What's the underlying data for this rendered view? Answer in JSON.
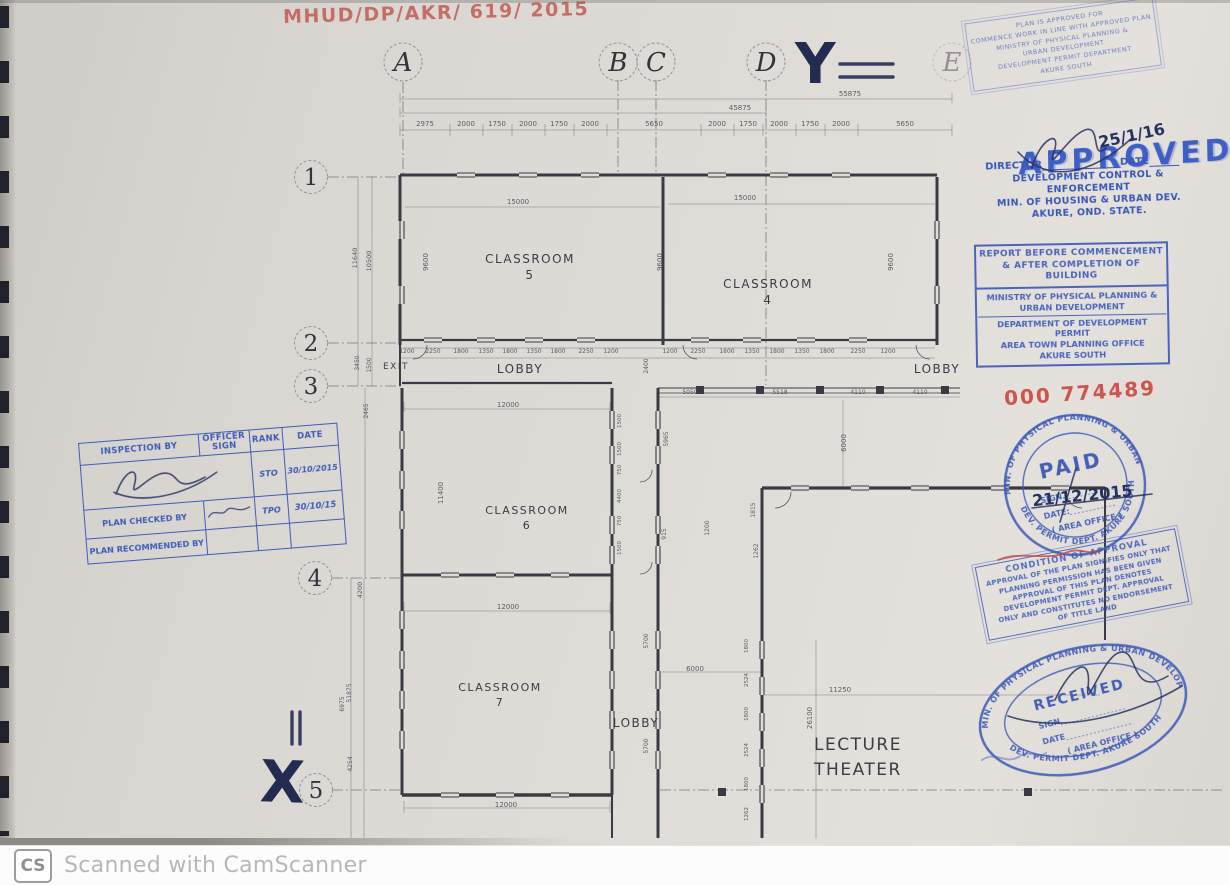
{
  "page": {
    "watermark_icon": "CS",
    "watermark_text": "Scanned with CamScanner"
  },
  "colors": {
    "stamp_blue": "#3a57b8",
    "ink_red": "#c0544c",
    "pen_navy": "#26335e",
    "paper": "#dedad5",
    "line": "#3a3a43"
  },
  "annotations": {
    "file_number": "MHUD/DP/AKR/ 619/ 2015",
    "receipt_number": "000 774489",
    "mark_x": "X",
    "mark_y": "Y",
    "approval_date": "25/1/16",
    "paid_date": "21/12/2015"
  },
  "grid": {
    "columns": [
      {
        "label": "A",
        "x": 403
      },
      {
        "label": "B",
        "x": 618
      },
      {
        "label": "C",
        "x": 656
      },
      {
        "label": "D",
        "x": 766
      },
      {
        "label": "E",
        "x": 952,
        "faint": true
      }
    ],
    "rows": [
      {
        "label": "1",
        "x": 311,
        "y": 177
      },
      {
        "label": "2",
        "x": 311,
        "y": 343
      },
      {
        "label": "3",
        "x": 311,
        "y": 386
      },
      {
        "label": "4",
        "x": 315,
        "y": 578
      },
      {
        "label": "5",
        "x": 316,
        "y": 790
      }
    ]
  },
  "plan": {
    "texts": [
      [
        "CLASSROOM",
        530,
        263,
        12,
        0,
        "room"
      ],
      [
        "5",
        530,
        279,
        12,
        0,
        "room"
      ],
      [
        "CLASSROOM",
        768,
        288,
        12,
        0,
        "room"
      ],
      [
        "4",
        768,
        304,
        12,
        0,
        "room"
      ],
      [
        "CLASSROOM",
        527,
        514,
        11,
        0,
        "room"
      ],
      [
        "6",
        527,
        529,
        11,
        0,
        "room"
      ],
      [
        "CLASSROOM",
        500,
        691,
        11,
        0,
        "room"
      ],
      [
        "7",
        500,
        706,
        11,
        0,
        "room"
      ],
      [
        "LOBBY",
        520,
        373,
        12,
        0,
        "room"
      ],
      [
        "LOBBY",
        937,
        373,
        12,
        0,
        "room"
      ],
      [
        "LOBBY",
        636,
        727,
        12,
        0,
        "room"
      ],
      [
        "EXIT",
        396,
        369,
        9,
        0,
        "room"
      ],
      [
        "LECTURE",
        858,
        750,
        17,
        0,
        "room"
      ],
      [
        "THEATER",
        858,
        775,
        17,
        0,
        "room"
      ],
      [
        "2975",
        425,
        126
      ],
      [
        "2000",
        466,
        126
      ],
      [
        "1750",
        497,
        126
      ],
      [
        "2000",
        528,
        126
      ],
      [
        "1750",
        559,
        126
      ],
      [
        "2000",
        590,
        126
      ],
      [
        "5650",
        654,
        126
      ],
      [
        "2000",
        717,
        126
      ],
      [
        "1750",
        748,
        126
      ],
      [
        "2000",
        779,
        126
      ],
      [
        "1750",
        810,
        126
      ],
      [
        "2000",
        841,
        126
      ],
      [
        "5650",
        905,
        126
      ],
      [
        "45875",
        740,
        110
      ],
      [
        "55875",
        850,
        96
      ],
      [
        "15000",
        518,
        204
      ],
      [
        "15000",
        745,
        200
      ],
      [
        "9600",
        428,
        262,
        7,
        -90
      ],
      [
        "9600",
        662,
        262,
        7,
        -90
      ],
      [
        "9600",
        893,
        262,
        7,
        -90
      ],
      [
        "1200",
        407,
        353,
        6
      ],
      [
        "2250",
        433,
        353,
        6
      ],
      [
        "1800",
        461,
        353,
        6
      ],
      [
        "1350",
        486,
        353,
        6
      ],
      [
        "1800",
        510,
        353,
        6
      ],
      [
        "1350",
        534,
        353,
        6
      ],
      [
        "1800",
        558,
        353,
        6
      ],
      [
        "2250",
        586,
        353,
        6
      ],
      [
        "1200",
        611,
        353,
        6
      ],
      [
        "1200",
        670,
        353,
        6
      ],
      [
        "2250",
        698,
        353,
        6
      ],
      [
        "1800",
        727,
        353,
        6
      ],
      [
        "1350",
        752,
        353,
        6
      ],
      [
        "1800",
        777,
        353,
        6
      ],
      [
        "1350",
        802,
        353,
        6
      ],
      [
        "1800",
        827,
        353,
        6
      ],
      [
        "2250",
        858,
        353,
        6
      ],
      [
        "1200",
        888,
        353,
        6
      ],
      [
        "2400",
        648,
        366,
        6,
        -90
      ],
      [
        "11640",
        357,
        258,
        6.5,
        -90
      ],
      [
        "10500",
        371,
        261,
        6.5,
        -90
      ],
      [
        "3450",
        359,
        363,
        6,
        -90
      ],
      [
        "1500",
        371,
        365,
        6,
        -90
      ],
      [
        "2465",
        368,
        411,
        6,
        -90
      ],
      [
        "4200",
        362,
        590,
        6.5,
        -90
      ],
      [
        "51875",
        351,
        693,
        6,
        -90
      ],
      [
        "6975",
        344,
        704,
        6,
        -90
      ],
      [
        "4254",
        352,
        764,
        6,
        -90
      ],
      [
        "12000",
        508,
        407
      ],
      [
        "11400",
        443,
        493,
        7,
        -90
      ],
      [
        "12000",
        508,
        609
      ],
      [
        "12000",
        506,
        807
      ],
      [
        "5050",
        690,
        394,
        6
      ],
      [
        "5518",
        780,
        394,
        6
      ],
      [
        "4110",
        858,
        394,
        6
      ],
      [
        "4110",
        920,
        394,
        6
      ],
      [
        "5965",
        668,
        439,
        6,
        -90
      ],
      [
        "915",
        666,
        534,
        6,
        -90
      ],
      [
        "1500",
        621,
        421,
        5.5,
        -90
      ],
      [
        "1500",
        621,
        449,
        5.5,
        -90
      ],
      [
        "750",
        621,
        470,
        5.5,
        -90
      ],
      [
        "4400",
        621,
        496,
        5.5,
        -90
      ],
      [
        "750",
        621,
        521,
        5.5,
        -90
      ],
      [
        "1500",
        621,
        548,
        5.5,
        -90
      ],
      [
        "1200",
        709,
        528,
        6,
        -90
      ],
      [
        "1815",
        755,
        510,
        6,
        -90
      ],
      [
        "1262",
        758,
        551,
        6,
        -90
      ],
      [
        "6000",
        846,
        443,
        7,
        -90
      ],
      [
        "5700",
        648,
        641,
        6,
        -90
      ],
      [
        "5700",
        648,
        746,
        6,
        -90
      ],
      [
        "6000",
        695,
        671
      ],
      [
        "11250",
        840,
        692
      ],
      [
        "26100",
        812,
        718,
        7,
        -90
      ],
      [
        "1800",
        748,
        646,
        5.5,
        -90
      ],
      [
        "2524",
        748,
        680,
        5.5,
        -90
      ],
      [
        "1800",
        748,
        714,
        5.5,
        -90
      ],
      [
        "2524",
        748,
        750,
        5.5,
        -90
      ],
      [
        "1800",
        748,
        784,
        5.5,
        -90
      ],
      [
        "1262",
        748,
        814,
        5.5,
        -90
      ]
    ],
    "walls": [
      [
        400,
        175,
        937,
        175,
        3
      ],
      [
        400,
        175,
        400,
        345,
        3
      ],
      [
        663,
        177,
        663,
        345,
        3
      ],
      [
        937,
        177,
        937,
        345,
        3
      ],
      [
        400,
        340,
        937,
        340,
        2.2
      ],
      [
        400,
        345,
        400,
        386,
        2
      ],
      [
        402,
        383,
        612,
        383,
        2.2
      ],
      [
        402,
        388,
        402,
        795,
        3
      ],
      [
        612,
        388,
        612,
        795,
        3
      ],
      [
        658,
        388,
        658,
        838,
        3
      ],
      [
        612,
        795,
        612,
        838,
        2
      ],
      [
        402,
        575,
        612,
        575,
        3
      ],
      [
        402,
        795,
        612,
        795,
        3.5
      ],
      [
        762,
        488,
        762,
        838,
        3
      ],
      [
        762,
        488,
        1105,
        488,
        3.2
      ],
      [
        1105,
        488,
        1105,
        640,
        2
      ],
      [
        658,
        388,
        960,
        388,
        1
      ],
      [
        658,
        393,
        960,
        393,
        0.8
      ]
    ],
    "dlines": [
      [
        400,
        130,
        952,
        130
      ],
      [
        400,
        113,
        766,
        113
      ],
      [
        400,
        99,
        952,
        99
      ],
      [
        405,
        207,
        660,
        207
      ],
      [
        668,
        204,
        935,
        204
      ],
      [
        404,
        409,
        610,
        409
      ],
      [
        404,
        611,
        610,
        611
      ],
      [
        404,
        808,
        610,
        808
      ],
      [
        400,
        348,
        935,
        348
      ],
      [
        400,
        358,
        935,
        358
      ],
      [
        358,
        177,
        358,
        386
      ],
      [
        372,
        177,
        372,
        386
      ],
      [
        351,
        578,
        351,
        838
      ],
      [
        364,
        578,
        364,
        838
      ],
      [
        365,
        388,
        365,
        578
      ],
      [
        658,
        397,
        960,
        397
      ],
      [
        843,
        400,
        843,
        486
      ],
      [
        765,
        695,
        1100,
        695
      ],
      [
        816,
        640,
        816,
        838
      ],
      [
        660,
        672,
        762,
        672
      ]
    ],
    "ticks": [
      {
        "y1": 124,
        "y2": 136,
        "xs": [
          400,
          450,
          483,
          512,
          545,
          574,
          607,
          701,
          734,
          763,
          796,
          825,
          858,
          952
        ]
      },
      {
        "y1": 107,
        "y2": 117,
        "xs": [
          400,
          766
        ]
      },
      {
        "y1": 93,
        "y2": 103,
        "xs": [
          400,
          952
        ]
      },
      {
        "y1": 402,
        "y2": 412,
        "xs": [
          404,
          610
        ]
      },
      {
        "y1": 602,
        "y2": 614,
        "xs": [
          404,
          610
        ]
      },
      {
        "y1": 801,
        "y2": 813,
        "xs": [
          404,
          610
        ]
      }
    ],
    "dash": [
      [
        403,
        82,
        403,
        175
      ],
      [
        618,
        80,
        618,
        175
      ],
      [
        656,
        80,
        656,
        175
      ],
      [
        766,
        80,
        766,
        175
      ],
      [
        328,
        177,
        400,
        177
      ],
      [
        328,
        343,
        400,
        343
      ],
      [
        328,
        386,
        402,
        386
      ],
      [
        332,
        578,
        402,
        578
      ],
      [
        332,
        790,
        402,
        790
      ],
      [
        660,
        790,
        1225,
        790
      ],
      [
        766,
        175,
        766,
        385
      ]
    ],
    "windows": [
      [
        466,
        175,
        "h"
      ],
      [
        528,
        175,
        "h"
      ],
      [
        590,
        175,
        "h"
      ],
      [
        717,
        175,
        "h"
      ],
      [
        779,
        175,
        "h"
      ],
      [
        841,
        175,
        "h"
      ],
      [
        433,
        340,
        "h"
      ],
      [
        486,
        340,
        "h"
      ],
      [
        534,
        340,
        "h"
      ],
      [
        586,
        340,
        "h"
      ],
      [
        700,
        340,
        "h"
      ],
      [
        752,
        340,
        "h"
      ],
      [
        806,
        340,
        "h"
      ],
      [
        858,
        340,
        "h"
      ],
      [
        450,
        575,
        "h"
      ],
      [
        505,
        575,
        "h"
      ],
      [
        560,
        575,
        "h"
      ],
      [
        450,
        795,
        "h"
      ],
      [
        505,
        795,
        "h"
      ],
      [
        560,
        795,
        "h"
      ],
      [
        800,
        488,
        "h"
      ],
      [
        860,
        488,
        "h"
      ],
      [
        920,
        488,
        "h"
      ],
      [
        1000,
        488,
        "h"
      ],
      [
        1060,
        488,
        "h"
      ],
      [
        402,
        230,
        "v"
      ],
      [
        402,
        295,
        "v"
      ],
      [
        402,
        440,
        "v"
      ],
      [
        402,
        480,
        "v"
      ],
      [
        402,
        520,
        "v"
      ],
      [
        402,
        620,
        "v"
      ],
      [
        402,
        660,
        "v"
      ],
      [
        402,
        700,
        "v"
      ],
      [
        402,
        740,
        "v"
      ],
      [
        612,
        420,
        "v"
      ],
      [
        612,
        455,
        "v"
      ],
      [
        612,
        525,
        "v"
      ],
      [
        612,
        555,
        "v"
      ],
      [
        612,
        640,
        "v"
      ],
      [
        612,
        680,
        "v"
      ],
      [
        612,
        720,
        "v"
      ],
      [
        612,
        760,
        "v"
      ],
      [
        658,
        420,
        "v"
      ],
      [
        658,
        455,
        "v"
      ],
      [
        658,
        525,
        "v"
      ],
      [
        658,
        555,
        "v"
      ],
      [
        658,
        640,
        "v"
      ],
      [
        658,
        680,
        "v"
      ],
      [
        658,
        720,
        "v"
      ],
      [
        658,
        760,
        "v"
      ],
      [
        762,
        650,
        "v"
      ],
      [
        762,
        686,
        "v"
      ],
      [
        762,
        722,
        "v"
      ],
      [
        762,
        758,
        "v"
      ],
      [
        762,
        794,
        "v"
      ],
      [
        937,
        230,
        "v"
      ],
      [
        937,
        295,
        "v"
      ],
      [
        700,
        390,
        "p"
      ],
      [
        760,
        390,
        "p"
      ],
      [
        820,
        390,
        "p"
      ],
      [
        880,
        390,
        "p"
      ],
      [
        945,
        390,
        "p"
      ],
      [
        722,
        792,
        "p"
      ],
      [
        1028,
        792,
        "p"
      ]
    ],
    "arcs": [
      [
        413,
        345,
        14,
        1
      ],
      [
        697,
        345,
        14,
        2
      ],
      [
        930,
        345,
        14,
        2
      ],
      [
        775,
        492,
        16,
        1
      ],
      [
        1082,
        492,
        16,
        2
      ],
      [
        640,
        470,
        12,
        1
      ],
      [
        640,
        562,
        12,
        1
      ]
    ]
  },
  "stamps": {
    "warning": {
      "lines": [
        "PLAN IS APPROVED FOR",
        "COMMENCE WORK IN LINE WITH APPROVED PLAN",
        "MINISTRY OF PHYSICAL PLANNING &",
        "URBAN DEVELOPMENT",
        "DEVELOPMENT PERMIT DEPARTMENT",
        "AKURE SOUTH"
      ]
    },
    "approved": "APPROVED",
    "director": {
      "director_label": "DIRECTOR",
      "date_label": "DATE",
      "lines": [
        "DEVELOPMENT CONTROL & ENFORCEMENT",
        "MIN. OF HOUSING & URBAN DEV.",
        "AKURE, OND. STATE."
      ]
    },
    "report": {
      "top_lines": [
        "REPORT BEFORE COMMENCEMENT",
        "& AFTER COMPLETION OF BUILDING"
      ],
      "bottom_lines": [
        "MINISTRY OF PHYSICAL PLANNING &",
        "URBAN DEVELOPMENT",
        "DEPARTMENT OF DEVELOPMENT PERMIT",
        "AREA TOWN PLANNING OFFICE",
        "AKURE SOUTH"
      ]
    },
    "paid": {
      "ring_top": "MIN. OF PHYSICAL PLANNING & URBAN DEV.",
      "ring_bottom": "DEV. PERMIT DEPT. AKURE SOUTH",
      "title": "PAID",
      "sign_label": "SIGN.",
      "date_label": "DATE:",
      "office_label": "( AREA OFFICE )"
    },
    "condition": {
      "lines": [
        "CONDITION OF APPROVAL",
        "APPROVAL OF THE PLAN SIGNIFIES ONLY THAT",
        "PLANNING PERMISSION HAS BEEN GIVEN",
        "APPROVAL OF THIS PLAN DENOTES",
        "DEVELOPMENT PERMIT DEPT. APPROVAL",
        "ONLY AND CONSTITUTES NO ENDORSEMENT",
        "OF TITLE LAND"
      ]
    },
    "received": {
      "ring_top": "MIN. OF PHYSICAL PLANNING & URBAN DEVELOPMENT",
      "ring_bottom": "DEV. PERMIT DEPT. AKURE SOUTH",
      "title": "RECEIVED",
      "sign_label": "SIGN",
      "date_label": "DATE",
      "office_label": "( AREA OFFICE )"
    },
    "inspection": {
      "headers": [
        "INSPECTION BY",
        "OFFICER SIGN",
        "RANK",
        "DATE"
      ],
      "row1": {
        "rank": "STO",
        "date": "30/10/2015"
      },
      "row2": {
        "label": "PLAN CHECKED BY",
        "rank": "TPO",
        "date": "30/10/15"
      },
      "row3": {
        "label": "PLAN RECOMMENDED BY"
      }
    }
  }
}
